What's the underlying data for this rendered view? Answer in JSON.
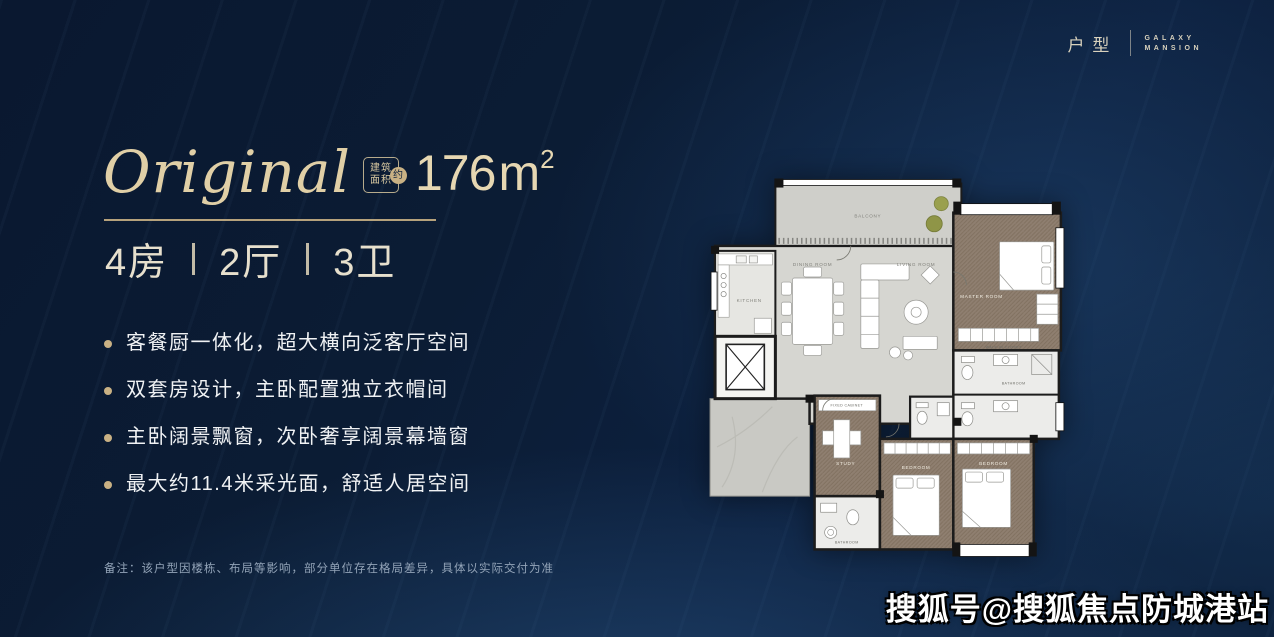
{
  "header": {
    "category": "户型",
    "brand1": "GALAXY",
    "brand2": "MANSION"
  },
  "unit": {
    "name": "Original",
    "badge1": "建筑",
    "badge2": "面积",
    "badge_circle": "约",
    "area_value": "176",
    "area_unit": "m",
    "area_sup": "2",
    "spec": {
      "rooms": "4房",
      "halls": "2厅",
      "baths": "3卫"
    }
  },
  "features": [
    "客餐厨一体化，超大横向泛客厅空间",
    "双套房设计，主卧配置独立衣帽间",
    "主卧阔景飘窗，次卧奢享阔景幕墙窗",
    "最大约11.4米采光面，舒适人居空间"
  ],
  "note": "备注：该户型因楼栋、布局等影响，部分单位存在格局差异，具体以实际交付为准",
  "watermark": "搜狐号@搜狐焦点防城港站",
  "floorplan": {
    "labels": {
      "balcony": "BALCONY",
      "kitchen": "KITCHEN",
      "dining": "DINING ROOM",
      "living": "LIVING ROOM",
      "master": "MASTER ROOM",
      "closet": "WALK-IN CLOSET",
      "bedroom_a": "BEDROOM",
      "bedroom_b": "BEDROOM",
      "study": "STUDY",
      "cabinet": "FIXED CABINET",
      "bath_a": "BATHROOM",
      "bath_b": "BATHROOM"
    }
  },
  "colors": {
    "background": "#0c1d36",
    "accent_gold": "#c9b184",
    "title_gold": "#e0cfa6",
    "text_white": "#f0f2f4",
    "note_gray": "#93a4b8"
  }
}
